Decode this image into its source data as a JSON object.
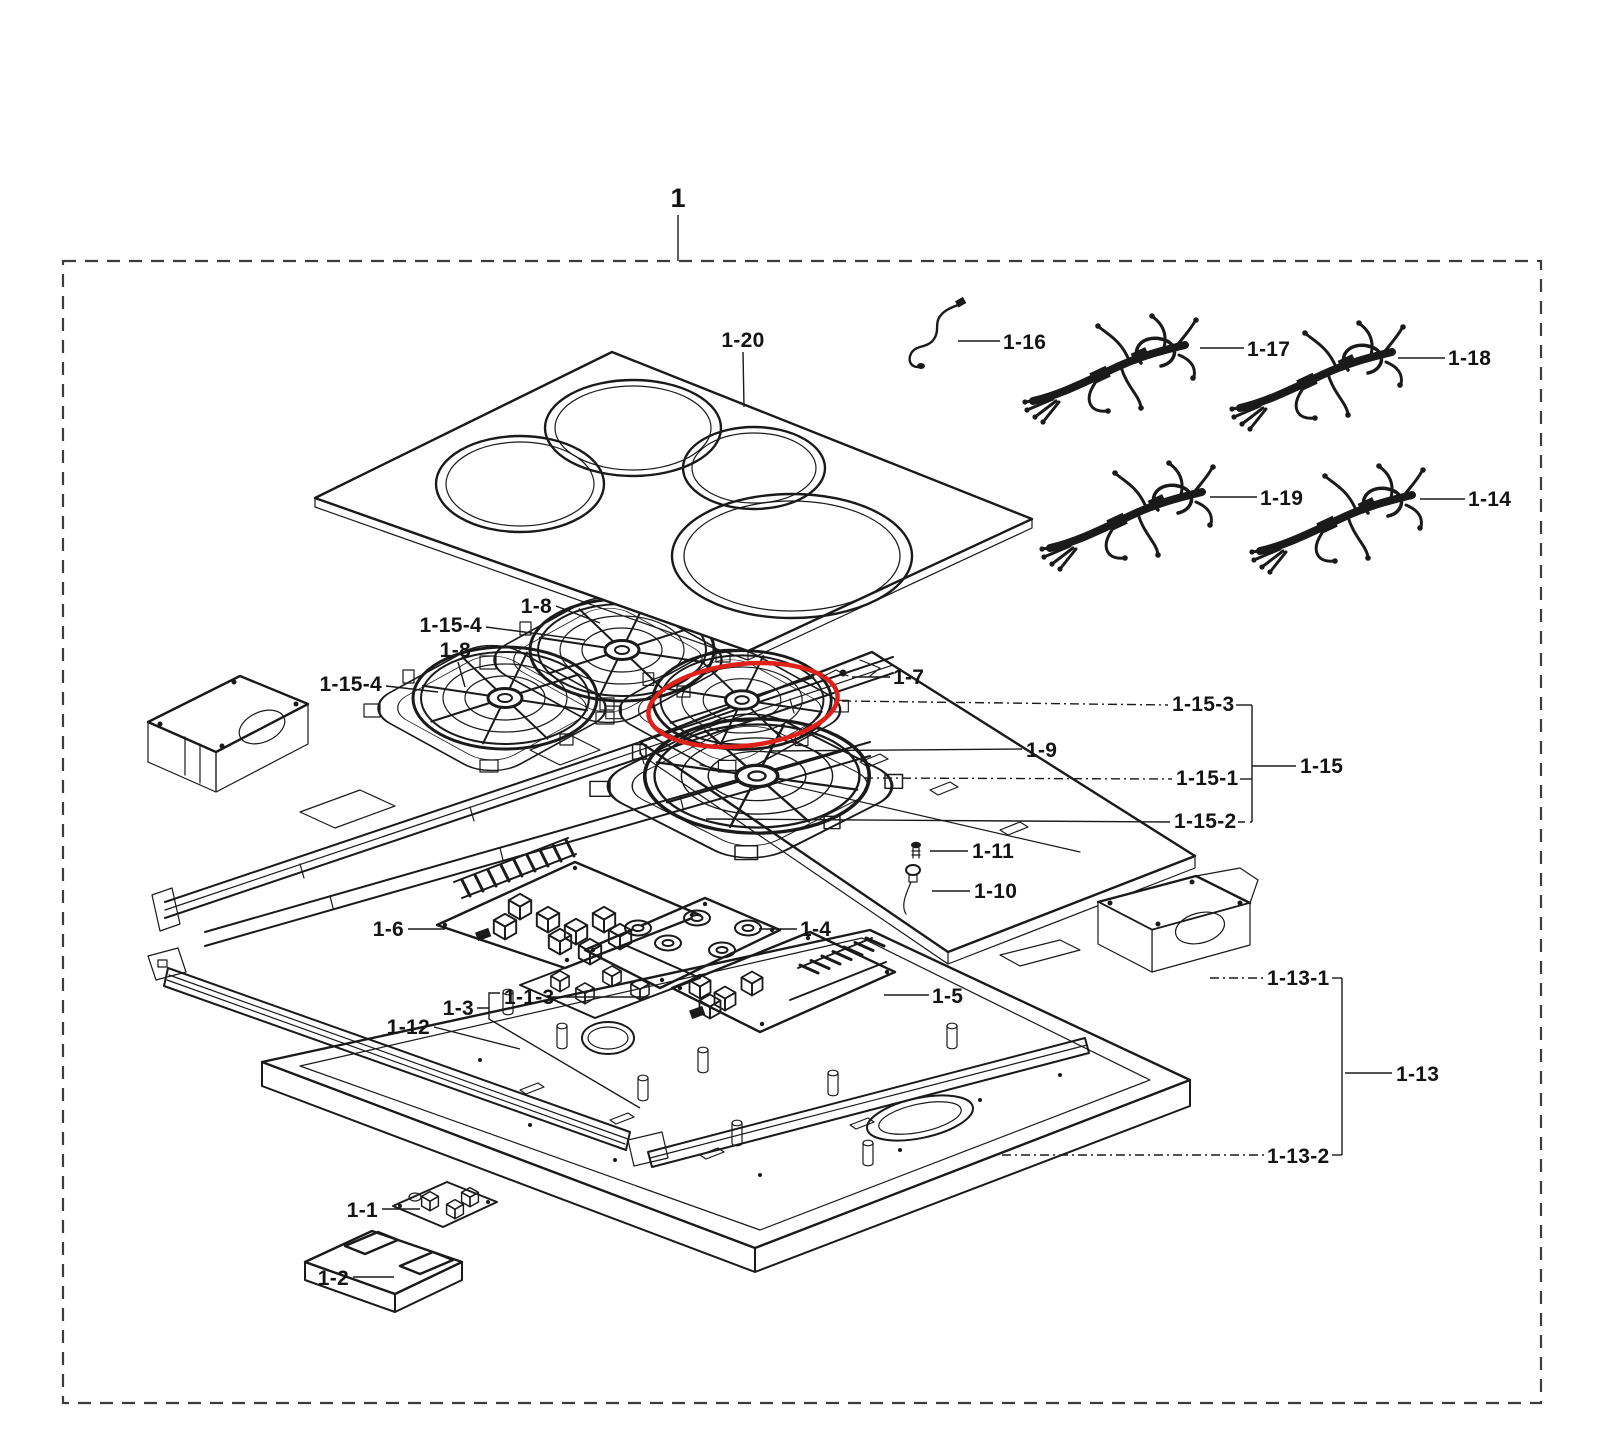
{
  "subject": "cooktop exploded parts view",
  "colors": {
    "background": "#ffffff",
    "line": "#1a1a1a",
    "border": "#3c3c3c",
    "highlight": "#e0211a"
  },
  "parts": {
    "assembly": "1",
    "glass_top": "1-20",
    "wire": "1-16",
    "harness_1": "1-17",
    "harness_2": "1-18",
    "harness_3": "1-19",
    "harness_4": "1-14",
    "coil": "1-8",
    "coil_plate": "1-15-4",
    "screw_top": "1-7",
    "bracket_plate": "1-9",
    "coil_sub3": "1-15-3",
    "coil_sub1": "1-15-1",
    "coil_sub2": "1-15-2",
    "coil_assembly": "1-15",
    "screw_small": "1-11",
    "grommet": "1-10",
    "pcb_left": "1-6",
    "pcb_main": "1-4",
    "pcb_sub": "1-1-3",
    "pcb_small": "1-3",
    "rail": "1-12",
    "pcb_right": "1-5",
    "blower": "1-13-1",
    "base_assembly": "1-13",
    "base_pan": "1-13-2",
    "control_board": "1-1",
    "cover": "1-2"
  }
}
